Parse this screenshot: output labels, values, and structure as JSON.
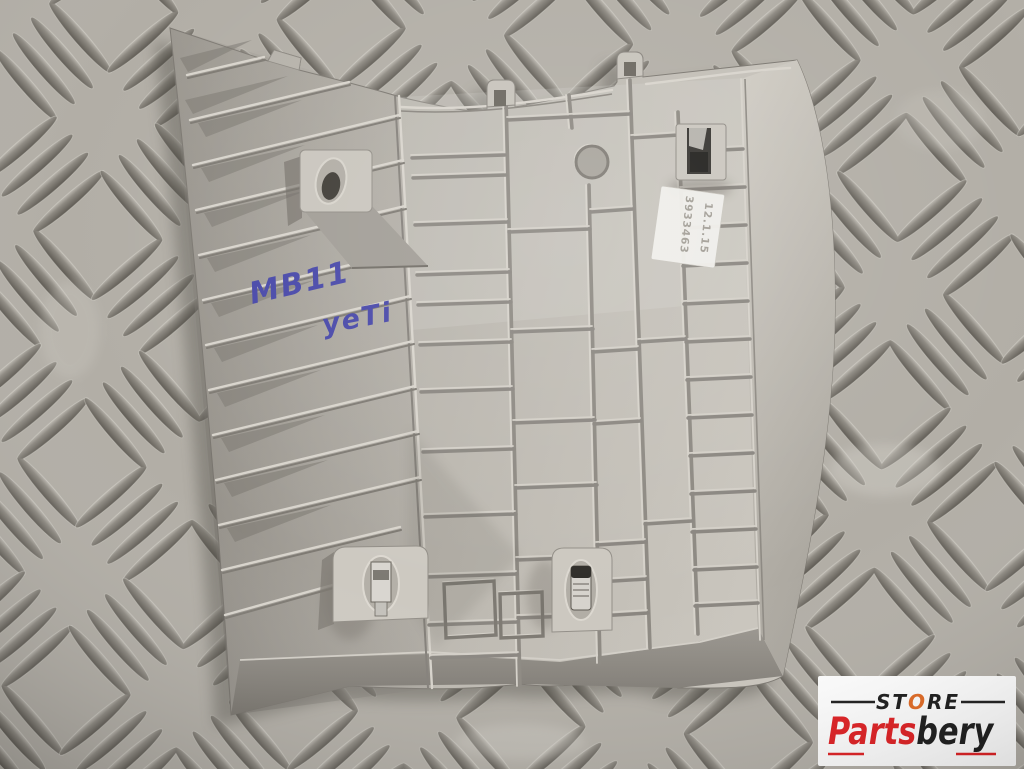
{
  "handwriting": {
    "line1": "MB11",
    "line2": "yeTi",
    "ink_color": "#4747a8"
  },
  "label": {
    "line1": "3933463",
    "line2": "12.1.15"
  },
  "logo": {
    "store_st": "ST",
    "store_o": "O",
    "store_re": "RE",
    "brand_parts": "Parts",
    "brand_bery": "bery",
    "parts_color": "#e01b1e",
    "bery_color": "#171717",
    "store_color": "#171717",
    "o_color": "#e2671f",
    "background": "#ffffff"
  },
  "colors": {
    "plate_base": "#b2aea6",
    "plate_groove": "#6b675f",
    "part_light": "#c6c2ba",
    "part_mid": "#aeaaa2",
    "part_shadow": "#8f8b83",
    "clip_metal": "#d7d4ce",
    "clip_dark": "#33312d"
  }
}
